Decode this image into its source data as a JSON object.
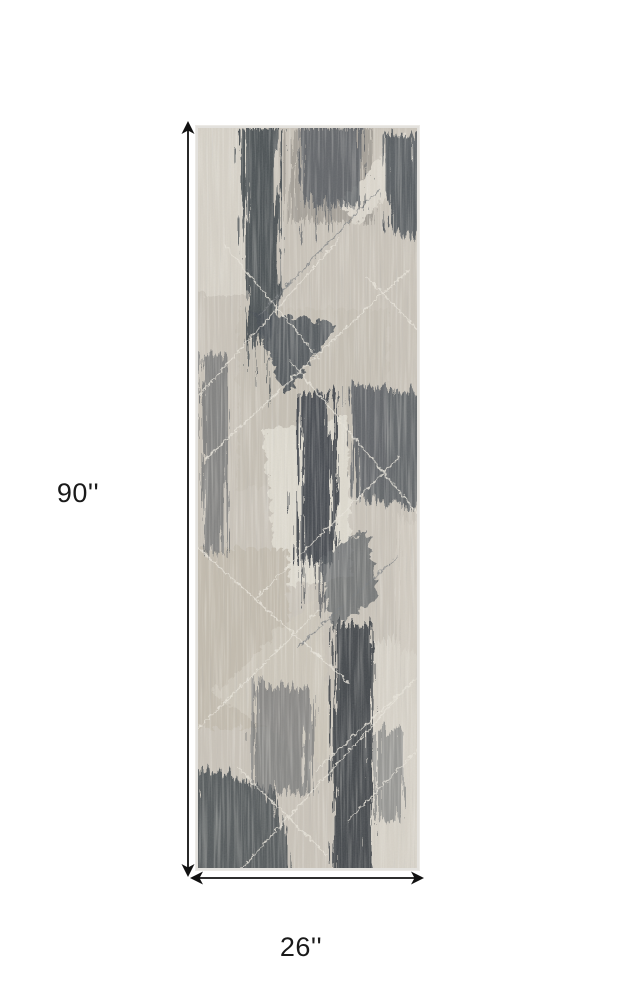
{
  "diagram": {
    "type": "product-dimension-diagram",
    "item": "abstract-distressed-runner-rug",
    "height_label": "90''",
    "width_label": "26''"
  },
  "colors": {
    "background": "#ffffff",
    "label_text": "#1a1a1a",
    "arrow": "#111111",
    "rug_base": "#cac4ba",
    "rug_light": "#d7d2c8",
    "rug_cream": "#dfdbd0",
    "rug_charcoal": "#4d5257",
    "rug_taupe": "#c3bcaf"
  }
}
